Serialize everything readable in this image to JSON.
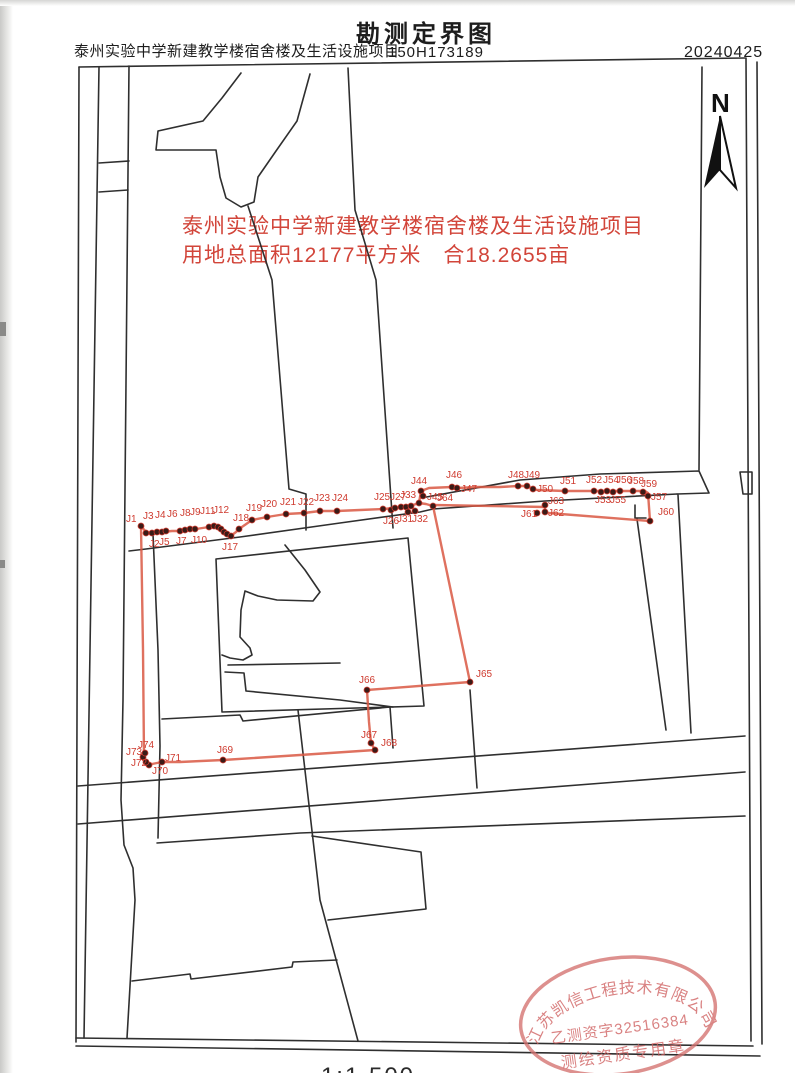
{
  "header": {
    "project_name": "泰州实验中学新建教学楼宿舍楼及生活设施项目",
    "map_title": "勘测定界图",
    "project_number": "150H173189",
    "date": "20240425"
  },
  "annotation": {
    "line1": "泰州实验中学新建教学楼宿舍楼及生活设施项目",
    "line2": "用地总面积12177平方米　合18.2655亩",
    "color": "#d2453a"
  },
  "north_arrow": {
    "label": "N"
  },
  "scale": {
    "text": "1:1 500"
  },
  "stamp": {
    "company": "江苏凯信工程技术有限公司",
    "license": "乙测资字32516384",
    "seal_type": "测绘资质专用章",
    "color": "#d4716f"
  },
  "map": {
    "line_color": "#2f2f2f",
    "boundary_color": "#d95843",
    "point_fill": "#3a1b17",
    "label_color": "#cf3b2f",
    "red_polylines": {
      "main_loop": [
        [
          141,
          526
        ],
        [
          146,
          532
        ],
        [
          154,
          533
        ],
        [
          162,
          532
        ],
        [
          172,
          531
        ],
        [
          180,
          531
        ],
        [
          190,
          529
        ],
        [
          196,
          529
        ],
        [
          209,
          527
        ],
        [
          214,
          526
        ],
        [
          218,
          527
        ],
        [
          222,
          530
        ],
        [
          225,
          533
        ],
        [
          229,
          536
        ],
        [
          232,
          535
        ],
        [
          236,
          532
        ],
        [
          239,
          529
        ],
        [
          252,
          520
        ],
        [
          267,
          517
        ],
        [
          286,
          514
        ],
        [
          304,
          513
        ],
        [
          320,
          511
        ],
        [
          337,
          511
        ],
        [
          360,
          510
        ],
        [
          383,
          509
        ],
        [
          395,
          508
        ],
        [
          406,
          506
        ],
        [
          413,
          505
        ],
        [
          419,
          503
        ],
        [
          426,
          504
        ],
        [
          433,
          506
        ],
        [
          470,
          682
        ],
        [
          367,
          690
        ],
        [
          369,
          722
        ],
        [
          371,
          743
        ],
        [
          375,
          750
        ],
        [
          300,
          755
        ],
        [
          223,
          760
        ],
        [
          180,
          762
        ],
        [
          162,
          762
        ],
        [
          152,
          764
        ],
        [
          147,
          764
        ],
        [
          144,
          757
        ],
        [
          143,
          650
        ],
        [
          141,
          526
        ]
      ],
      "strip": [
        [
          421,
          491
        ],
        [
          429,
          488
        ],
        [
          452,
          487
        ],
        [
          457,
          488
        ],
        [
          478,
          487
        ],
        [
          500,
          487
        ],
        [
          518,
          486
        ],
        [
          527,
          486
        ],
        [
          533,
          489
        ],
        [
          537,
          490
        ],
        [
          565,
          491
        ],
        [
          594,
          491
        ],
        [
          607,
          491
        ],
        [
          620,
          491
        ],
        [
          633,
          491
        ],
        [
          645,
          491
        ],
        [
          648,
          493
        ],
        [
          650,
          521
        ],
        [
          548,
          513
        ],
        [
          545,
          512
        ],
        [
          545,
          507
        ],
        [
          433,
          505
        ]
      ],
      "connector": [
        [
          419,
          503
        ],
        [
          421,
          491
        ]
      ]
    },
    "boundary_points": [
      {
        "label": "J1",
        "x": 141,
        "y": 526,
        "lx": 126,
        "ly": 522
      },
      {
        "label": "J2",
        "x": 146,
        "y": 533,
        "lx": 149,
        "ly": 547
      },
      {
        "label": "J3",
        "x": 152,
        "y": 533,
        "lx": 143,
        "ly": 519
      },
      {
        "label": "J4",
        "x": 157,
        "y": 532,
        "lx": 155,
        "ly": 518
      },
      {
        "label": "J5",
        "x": 162,
        "y": 532,
        "lx": 159,
        "ly": 545
      },
      {
        "label": "J6",
        "x": 166,
        "y": 531,
        "lx": 167,
        "ly": 517
      },
      {
        "label": "J7",
        "x": 180,
        "y": 531,
        "lx": 176,
        "ly": 544
      },
      {
        "label": "J8",
        "x": 185,
        "y": 530,
        "lx": 180,
        "ly": 516
      },
      {
        "label": "J9",
        "x": 190,
        "y": 529,
        "lx": 190,
        "ly": 515
      },
      {
        "label": "J10",
        "x": 195,
        "y": 529,
        "lx": 191,
        "ly": 543
      },
      {
        "label": "J11",
        "x": 209,
        "y": 527,
        "lx": 200,
        "ly": 514
      },
      {
        "label": "J12",
        "x": 214,
        "y": 526,
        "lx": 213,
        "ly": 513
      },
      {
        "label": "",
        "x": 218,
        "y": 527,
        "lx": 0,
        "ly": 0
      },
      {
        "label": "",
        "x": 221,
        "y": 529,
        "lx": 0,
        "ly": 0
      },
      {
        "label": "",
        "x": 224,
        "y": 532,
        "lx": 0,
        "ly": 0
      },
      {
        "label": "",
        "x": 227,
        "y": 534,
        "lx": 0,
        "ly": 0
      },
      {
        "label": "J17",
        "x": 231,
        "y": 536,
        "lx": 222,
        "ly": 550
      },
      {
        "label": "J18",
        "x": 239,
        "y": 529,
        "lx": 233,
        "ly": 521
      },
      {
        "label": "J19",
        "x": 252,
        "y": 520,
        "lx": 246,
        "ly": 511
      },
      {
        "label": "J20",
        "x": 267,
        "y": 517,
        "lx": 261,
        "ly": 507
      },
      {
        "label": "J21",
        "x": 286,
        "y": 514,
        "lx": 280,
        "ly": 505
      },
      {
        "label": "J22",
        "x": 304,
        "y": 513,
        "lx": 298,
        "ly": 505
      },
      {
        "label": "J23",
        "x": 320,
        "y": 511,
        "lx": 314,
        "ly": 501
      },
      {
        "label": "J24",
        "x": 337,
        "y": 511,
        "lx": 332,
        "ly": 501
      },
      {
        "label": "J25",
        "x": 383,
        "y": 509,
        "lx": 374,
        "ly": 500
      },
      {
        "label": "J26",
        "x": 391,
        "y": 510,
        "lx": 383,
        "ly": 524
      },
      {
        "label": "J27",
        "x": 395,
        "y": 508,
        "lx": 390,
        "ly": 500
      },
      {
        "label": "",
        "x": 401,
        "y": 507,
        "lx": 0,
        "ly": 0
      },
      {
        "label": "",
        "x": 406,
        "y": 507,
        "lx": 0,
        "ly": 0
      },
      {
        "label": "",
        "x": 411,
        "y": 506,
        "lx": 0,
        "ly": 0
      },
      {
        "label": "J31",
        "x": 408,
        "y": 512,
        "lx": 397,
        "ly": 522
      },
      {
        "label": "J32",
        "x": 415,
        "y": 511,
        "lx": 412,
        "ly": 522
      },
      {
        "label": "J33",
        "x": 419,
        "y": 503,
        "lx": 400,
        "ly": 498
      },
      {
        "label": "J44",
        "x": 421,
        "y": 491,
        "lx": 411,
        "ly": 484
      },
      {
        "label": "J45",
        "x": 423,
        "y": 496,
        "lx": 427,
        "ly": 500
      },
      {
        "label": "J46",
        "x": 452,
        "y": 487,
        "lx": 446,
        "ly": 478
      },
      {
        "label": "J47",
        "x": 457,
        "y": 488,
        "lx": 461,
        "ly": 492
      },
      {
        "label": "J48",
        "x": 518,
        "y": 486,
        "lx": 508,
        "ly": 478
      },
      {
        "label": "J49",
        "x": 527,
        "y": 486,
        "lx": 524,
        "ly": 478
      },
      {
        "label": "J50",
        "x": 533,
        "y": 489,
        "lx": 537,
        "ly": 492
      },
      {
        "label": "J51",
        "x": 565,
        "y": 491,
        "lx": 560,
        "ly": 484
      },
      {
        "label": "J52",
        "x": 594,
        "y": 491,
        "lx": 586,
        "ly": 483
      },
      {
        "label": "J53",
        "x": 601,
        "y": 492,
        "lx": 595,
        "ly": 503
      },
      {
        "label": "J54",
        "x": 607,
        "y": 491,
        "lx": 603,
        "ly": 483
      },
      {
        "label": "J55",
        "x": 613,
        "y": 492,
        "lx": 610,
        "ly": 503
      },
      {
        "label": "J56",
        "x": 620,
        "y": 491,
        "lx": 616,
        "ly": 483
      },
      {
        "label": "J57",
        "x": 648,
        "y": 496,
        "lx": 651,
        "ly": 500
      },
      {
        "label": "J58",
        "x": 633,
        "y": 491,
        "lx": 628,
        "ly": 484
      },
      {
        "label": "J59",
        "x": 643,
        "y": 492,
        "lx": 641,
        "ly": 487
      },
      {
        "label": "J60",
        "x": 650,
        "y": 521,
        "lx": 658,
        "ly": 515
      },
      {
        "label": "J61",
        "x": 537,
        "y": 513,
        "lx": 521,
        "ly": 517
      },
      {
        "label": "J62",
        "x": 545,
        "y": 512,
        "lx": 548,
        "ly": 516
      },
      {
        "label": "J63",
        "x": 545,
        "y": 505,
        "lx": 548,
        "ly": 504
      },
      {
        "label": "J64",
        "x": 433,
        "y": 506,
        "lx": 437,
        "ly": 501
      },
      {
        "label": "J65",
        "x": 470,
        "y": 682,
        "lx": 476,
        "ly": 677
      },
      {
        "label": "J66",
        "x": 367,
        "y": 690,
        "lx": 359,
        "ly": 683
      },
      {
        "label": "J67",
        "x": 371,
        "y": 743,
        "lx": 361,
        "ly": 738
      },
      {
        "label": "J68",
        "x": 375,
        "y": 750,
        "lx": 381,
        "ly": 746
      },
      {
        "label": "J69",
        "x": 223,
        "y": 760,
        "lx": 217,
        "ly": 753
      },
      {
        "label": "J70",
        "x": 149,
        "y": 765,
        "lx": 152,
        "ly": 774
      },
      {
        "label": "J71",
        "x": 162,
        "y": 762,
        "lx": 165,
        "ly": 761
      },
      {
        "label": "J72",
        "x": 146,
        "y": 762,
        "lx": 131,
        "ly": 766
      },
      {
        "label": "J73",
        "x": 143,
        "y": 757,
        "lx": 126,
        "ly": 755
      },
      {
        "label": "J74",
        "x": 145,
        "y": 753,
        "lx": 138,
        "ly": 748
      }
    ],
    "black_polylines": [
      [
        [
          79,
          67
        ],
        [
          745,
          58
        ]
      ],
      [
        [
          79,
          67
        ],
        [
          76,
          1042
        ]
      ],
      [
        [
          746,
          58
        ],
        [
          751,
          1041
        ]
      ],
      [
        [
          757,
          62
        ],
        [
          762,
          1044
        ]
      ],
      [
        [
          76,
          1038
        ],
        [
          753,
          1046
        ]
      ],
      [
        [
          76,
          1046
        ],
        [
          760,
          1056
        ]
      ],
      [
        [
          99,
          67
        ],
        [
          84,
          1038
        ]
      ],
      [
        [
          129,
          66
        ],
        [
          123,
          700
        ],
        [
          121,
          800
        ],
        [
          124,
          845
        ],
        [
          133,
          868
        ],
        [
          135,
          900
        ],
        [
          127,
          1038
        ]
      ],
      [
        [
          99,
          163
        ],
        [
          129,
          161
        ]
      ],
      [
        [
          99,
          192
        ],
        [
          128,
          190
        ]
      ],
      [
        [
          241,
          73
        ],
        [
          222,
          98
        ],
        [
          203,
          121
        ],
        [
          158,
          131
        ],
        [
          156,
          150
        ],
        [
          216,
          150
        ],
        [
          220,
          177
        ],
        [
          226,
          198
        ],
        [
          241,
          207
        ],
        [
          254,
          202
        ],
        [
          258,
          177
        ],
        [
          276,
          151
        ],
        [
          297,
          121
        ],
        [
          310,
          74
        ]
      ],
      [
        [
          248,
          206
        ],
        [
          272,
          280
        ],
        [
          289,
          489
        ],
        [
          306,
          494
        ],
        [
          306,
          530
        ]
      ],
      [
        [
          348,
          68
        ],
        [
          355,
          210
        ],
        [
          376,
          280
        ],
        [
          393,
          528
        ]
      ],
      [
        [
          421,
          498
        ],
        [
          520,
          480
        ],
        [
          600,
          474
        ],
        [
          699,
          471
        ],
        [
          709,
          493
        ],
        [
          677,
          494
        ]
      ],
      [
        [
          129,
          551
        ],
        [
          146,
          549
        ],
        [
          240,
          537
        ],
        [
          340,
          523
        ],
        [
          420,
          512
        ],
        [
          433,
          509
        ],
        [
          545,
          501
        ],
        [
          677,
          494
        ]
      ],
      [
        [
          702,
          67
        ],
        [
          699,
          470
        ]
      ],
      [
        [
          740,
          472
        ],
        [
          752,
          472
        ],
        [
          752,
          494
        ],
        [
          743,
          494
        ],
        [
          740,
          472
        ]
      ],
      [
        [
          635,
          505
        ],
        [
          635,
          518
        ],
        [
          646,
          518
        ]
      ],
      [
        [
          637,
          519
        ],
        [
          666,
          730
        ]
      ],
      [
        [
          678,
          495
        ],
        [
          691,
          733
        ]
      ],
      [
        [
          216,
          559
        ],
        [
          408,
          538
        ],
        [
          424,
          706
        ],
        [
          222,
          712
        ],
        [
          216,
          559
        ]
      ],
      [
        [
          285,
          545
        ],
        [
          305,
          570
        ],
        [
          320,
          592
        ],
        [
          313,
          601
        ],
        [
          277,
          600
        ],
        [
          258,
          596
        ],
        [
          245,
          591
        ],
        [
          241,
          610
        ],
        [
          240,
          637
        ],
        [
          250,
          648
        ],
        [
          252,
          655
        ],
        [
          243,
          660
        ],
        [
          230,
          658
        ],
        [
          222,
          655
        ]
      ],
      [
        [
          228,
          665
        ],
        [
          340,
          663
        ]
      ],
      [
        [
          225,
          672
        ],
        [
          244,
          673
        ],
        [
          246,
          691
        ],
        [
          340,
          700
        ],
        [
          393,
          707
        ]
      ],
      [
        [
          162,
          719
        ],
        [
          240,
          715
        ],
        [
          243,
          721
        ],
        [
          390,
          707
        ],
        [
          393,
          748
        ]
      ],
      [
        [
          470,
          690
        ],
        [
          477,
          788
        ]
      ],
      [
        [
          153,
          534
        ],
        [
          158,
          650
        ],
        [
          160,
          746
        ],
        [
          158,
          838
        ]
      ],
      [
        [
          78,
          786
        ],
        [
          745,
          736
        ]
      ],
      [
        [
          78,
          824
        ],
        [
          745,
          772
        ]
      ],
      [
        [
          157,
          843
        ],
        [
          300,
          833
        ],
        [
          745,
          816
        ]
      ],
      [
        [
          132,
          981
        ],
        [
          190,
          974
        ],
        [
          191,
          979
        ],
        [
          292,
          967
        ],
        [
          293,
          962
        ],
        [
          337,
          960
        ]
      ],
      [
        [
          298,
          710
        ],
        [
          320,
          900
        ],
        [
          358,
          1041
        ]
      ],
      [
        [
          312,
          836
        ],
        [
          421,
          852
        ],
        [
          426,
          909
        ],
        [
          328,
          920
        ]
      ]
    ]
  }
}
